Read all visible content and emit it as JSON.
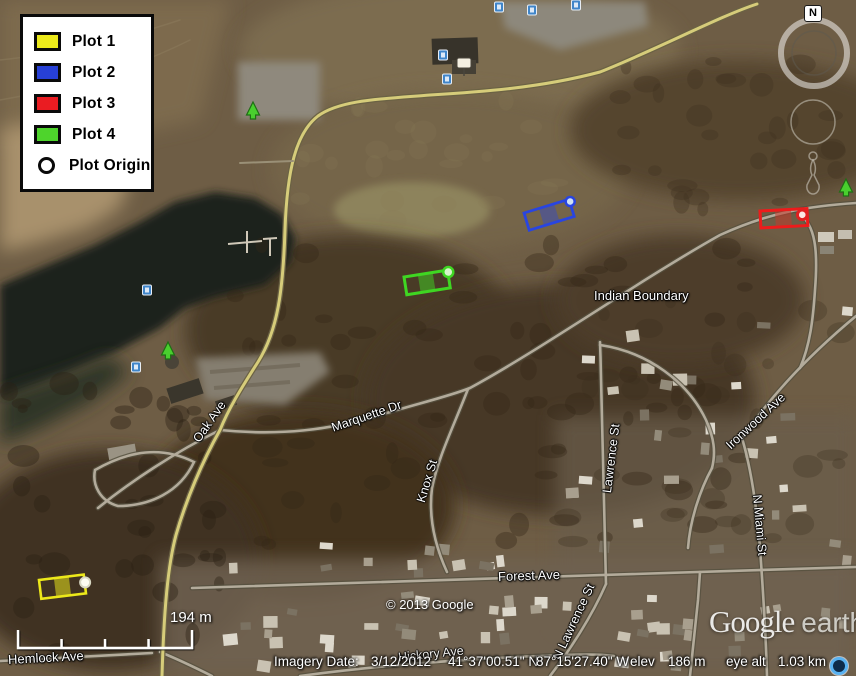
{
  "legend": {
    "items": [
      {
        "label": "Plot 1",
        "color": "#ecea1b"
      },
      {
        "label": "Plot 2",
        "color": "#2740d6"
      },
      {
        "label": "Plot 3",
        "color": "#ea1c22"
      },
      {
        "label": "Plot 4",
        "color": "#4ed42c"
      },
      {
        "label": "Plot Origin",
        "color": "#ffffff"
      }
    ]
  },
  "map": {
    "labels": {
      "indian_boundary": "Indian Boundary",
      "ironwood": "Ironwood Ave",
      "lawrence": "Lawrence St",
      "n_miami": "N Miami St",
      "marquette": "Marquette Dr",
      "oak": "Oak Ave",
      "knox": "Knox St",
      "forest": "Forest Ave",
      "n_lawrence": "N Lawrence St",
      "hemlock": "Hemlock Ave",
      "hickory": "Hickory Ave"
    },
    "copyright": "© 2013 Google",
    "scale_label": "194 m",
    "compass": "N"
  },
  "logo": {
    "google": "Google",
    "earth": "earth"
  },
  "status_bar": {
    "imagery_date_label": "Imagery Date:",
    "imagery_date": "3/12/2012",
    "latitude": "41°37'00.51\" N",
    "longitude": "87°15'27.40\" W",
    "elev_label": "elev",
    "elevation": "186 m",
    "eye_alt_label": "eye alt",
    "eye_altitude": "1.03 km"
  }
}
